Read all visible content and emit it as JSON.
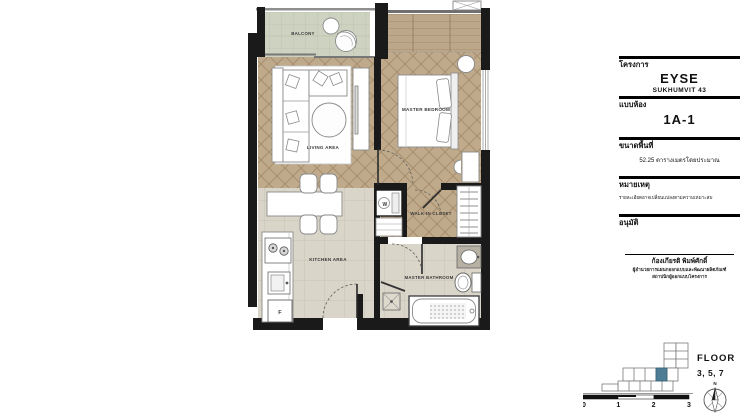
{
  "plan": {
    "labels": {
      "balcony": "BALCONY",
      "living": "LIVING AREA",
      "master_bedroom": "MASTER BEDROOM",
      "walk_in_closet": "WALK-IN CLOSET",
      "kitchen": "KITCHEN AREA",
      "master_bathroom": "MASTER BATHROOM",
      "washer": "W",
      "fridge": "F"
    }
  },
  "title_block": {
    "project_label": "โครงการ",
    "project_name": "EYSE",
    "project_subtitle": "SUKHUMVIT 43",
    "unit_label": "แบบห้อง",
    "unit_name": "1A-1",
    "area_label": "ขนาดพื้นที่",
    "area_value": "52.25 ตารางเมตรโดยประมาณ",
    "remark_label": "หมายเหตุ",
    "remark_text": "รายละเอียดอาจเปลี่ยนแปลงตามความเหมาะสม",
    "approval_label": "อนุมัติ",
    "approver_name": "ก้องเกียรติ พิมพ์ศักดิ์",
    "approver_title_line1": "ผู้อำนวยการแผนกออกแบบและพัฒนาผลิตภัณฑ์",
    "approver_title_line2": "สถาปนิกผู้ออกแบบโครงการ"
  },
  "key_plan": {
    "floor_label": "FLOOR",
    "floor_numbers": "3, 5, 7",
    "compass_north": "N",
    "scale_ticks": [
      "0",
      "1",
      "2",
      "3"
    ]
  },
  "colors": {
    "wall": "#1a1a1a",
    "wood_floor": "#c0aa8c",
    "tile_floor": "#d9d5c9",
    "balcony_floor": "#ced3c1",
    "key_plan_highlight": "#4c7d95"
  }
}
